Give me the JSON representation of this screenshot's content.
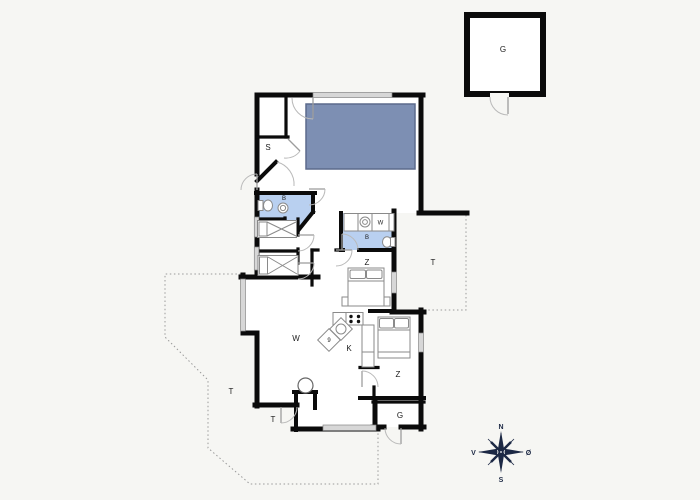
{
  "plan": {
    "rooms": {
      "sauna": "S",
      "bathroom1": "B",
      "bathroom2": "B",
      "washer": "W",
      "bedroom_middle": "Z",
      "bedroom_corner": "Z",
      "living_room": "W",
      "kitchen": "K",
      "appliance": "9",
      "utility": "G",
      "garage": "G",
      "terrace_left": "T",
      "terrace_right": "T",
      "terrace_entry": "T"
    },
    "compass": {
      "north": "N",
      "south": "S",
      "west": "V",
      "east": "Ø"
    },
    "colors": {
      "pool": "#7d8fb3",
      "pool_border": "#5c6a8c",
      "bathroom": "#b9d0f0",
      "wall": "#0b0b0b",
      "window": "#d7d7d7",
      "compass": "#1c2844",
      "background": "#f6f6f3"
    }
  }
}
